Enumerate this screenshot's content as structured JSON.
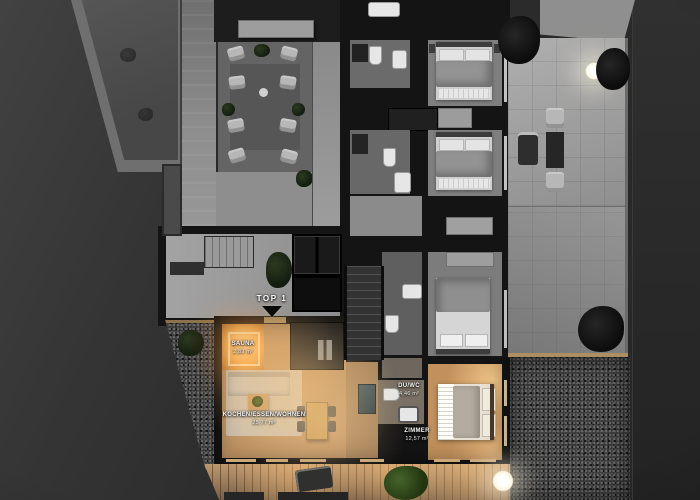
{
  "scene": {
    "type": "3d-floorplan-top-view",
    "unit": {
      "label": "TOP 1"
    },
    "rooms": {
      "sauna": {
        "name": "SAUNA",
        "area": "2,89 m²"
      },
      "living": {
        "name": "KOCHEN/ESSEN/WOHNEN",
        "area": "25,77 m²"
      },
      "duwc": {
        "name": "DU/WC",
        "area": "4,46 m²"
      },
      "zimmer": {
        "name": "ZIMMER",
        "area": "12,57 m²"
      }
    },
    "colors": {
      "background": "#272727",
      "wall": "#141414",
      "wood": "#bf9364",
      "terrace": "#a6a6a6",
      "deck": "#ab8a68",
      "sauna_glow": "#f5a94e",
      "warm_glow": "#ffcc88",
      "label": "#f4f4f2"
    }
  }
}
